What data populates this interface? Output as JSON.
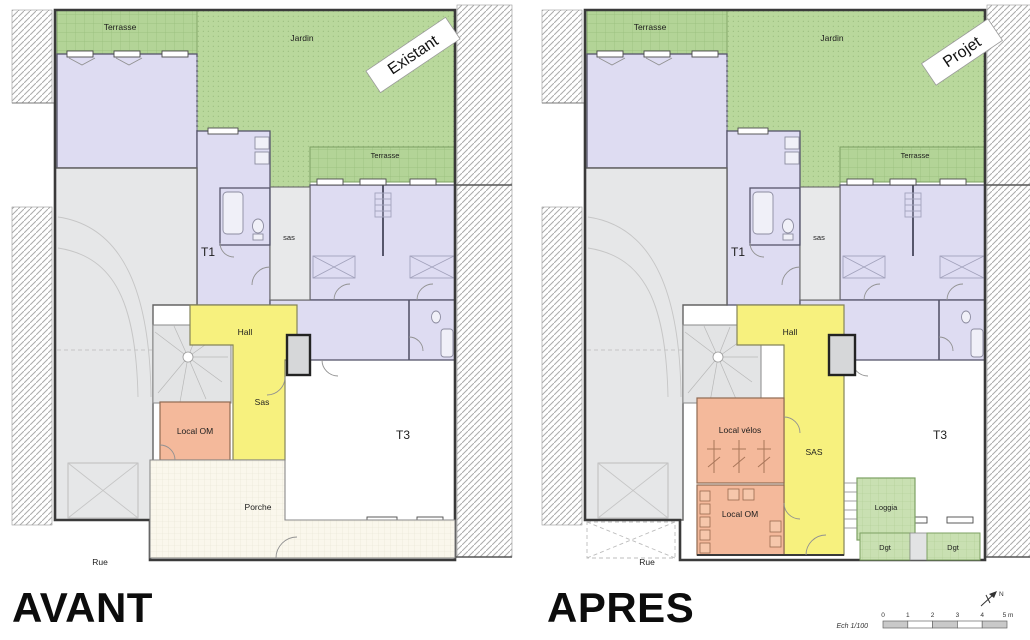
{
  "panel_avant": {
    "title": "AVANT",
    "stamp": "Existant",
    "rooms": {
      "terrasse_top": "Terrasse",
      "jardin": "Jardin",
      "terrasse_right": "Terrasse",
      "t1": "T1",
      "sas_upper": "sas",
      "hall": "Hall",
      "sas": "Sas",
      "local_om": "Local OM",
      "t3": "T3",
      "porche": "Porche",
      "rue": "Rue"
    }
  },
  "panel_apres": {
    "title": "APRES",
    "stamp": "Projet",
    "rooms": {
      "terrasse_top": "Terrasse",
      "jardin": "Jardin",
      "terrasse_right": "Terrasse",
      "t1": "T1",
      "sas_upper": "sas",
      "hall": "Hall",
      "sas": "SAS",
      "local_velos": "Local vélos",
      "local_om": "Local OM",
      "t3": "T3",
      "loggia": "Loggia",
      "dgt_left": "Dgt",
      "dgt_right": "Dgt",
      "rue": "Rue"
    }
  },
  "legend": {
    "scale_caption": "Ech 1/100",
    "scale_ticks": [
      "0",
      "1",
      "2",
      "3",
      "4",
      "5 m"
    ],
    "north_label": "N"
  },
  "colors": {
    "private_rooms": "#dedcf2",
    "circulation": "#f7f17e",
    "service": "#f4b99b",
    "garden": "#b9d89c",
    "exterior_annexe": "#c9e0b2",
    "porch": "#faf7ec",
    "common": "#e6e7e8"
  }
}
